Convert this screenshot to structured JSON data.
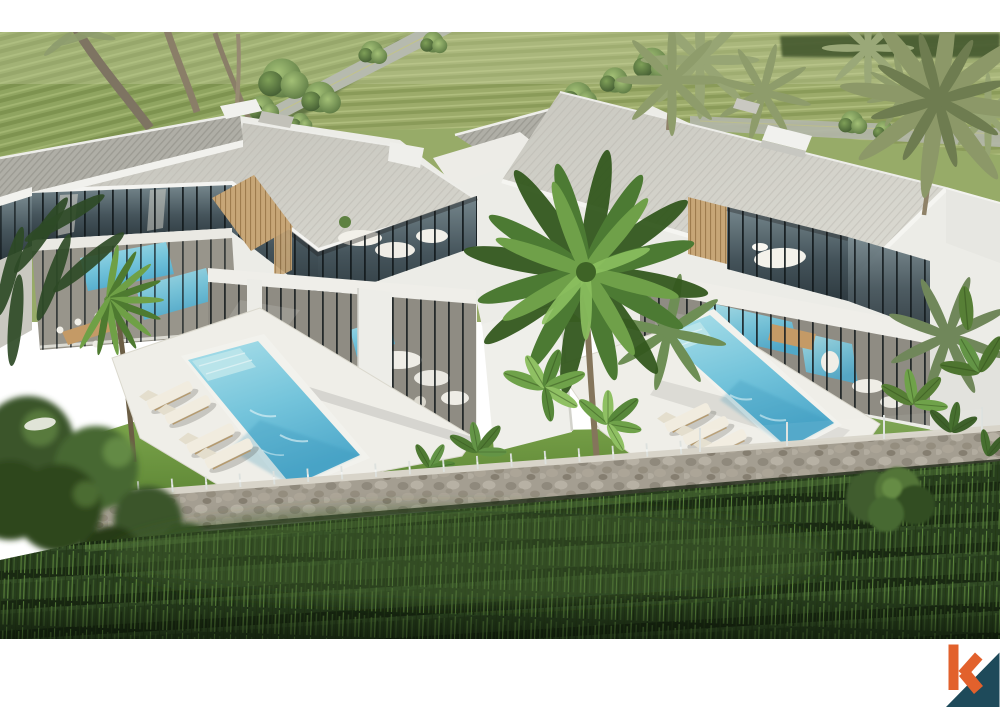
{
  "scene": {
    "description": "Aerial 3D architectural rendering of two modern two-storey white villas with flat grey roofs, floor-to-ceiling glass, timber slat accents, turquoise swimming pools with sun loungers, bright lawns and tropical palms and banana plants, bounded by a natural stone retaining wall with glass pool fencing, set among green rice paddy fields with a small access road; the render is letterboxed by white bands top and bottom with an orange and navy letter-k logo in the bottom-right corner",
    "villa_count": 2,
    "pool_count": 2,
    "sun_lounger_count": 7,
    "letterbox": "white bands at top and bottom"
  },
  "logo": {
    "letter": "k"
  },
  "palette": {
    "white_band": "#FFFFFF",
    "roof_light": "#CDCCC4",
    "roof_hatch": "#AFAEA6",
    "wall_white": "#ECECE7",
    "fascia": "#F4F4F1",
    "glass_dark": "#45545B",
    "mullion": "#12191C",
    "wood_slat": "#C7A677",
    "water_light": "#AADFE9",
    "water_deep": "#4FA9CB",
    "deck": "#EFEEE8",
    "lawn": "#6E9840",
    "field_green": "#97AB68",
    "road_grey": "#B6BAAE",
    "stone_wall": "#A49E91",
    "paddy_dark": "#273D1D",
    "foliage_dark": "#3A5429",
    "palm_green": "#4C7A33",
    "logo_orange": "#E2612C",
    "logo_navy": "#1E4A5A"
  }
}
